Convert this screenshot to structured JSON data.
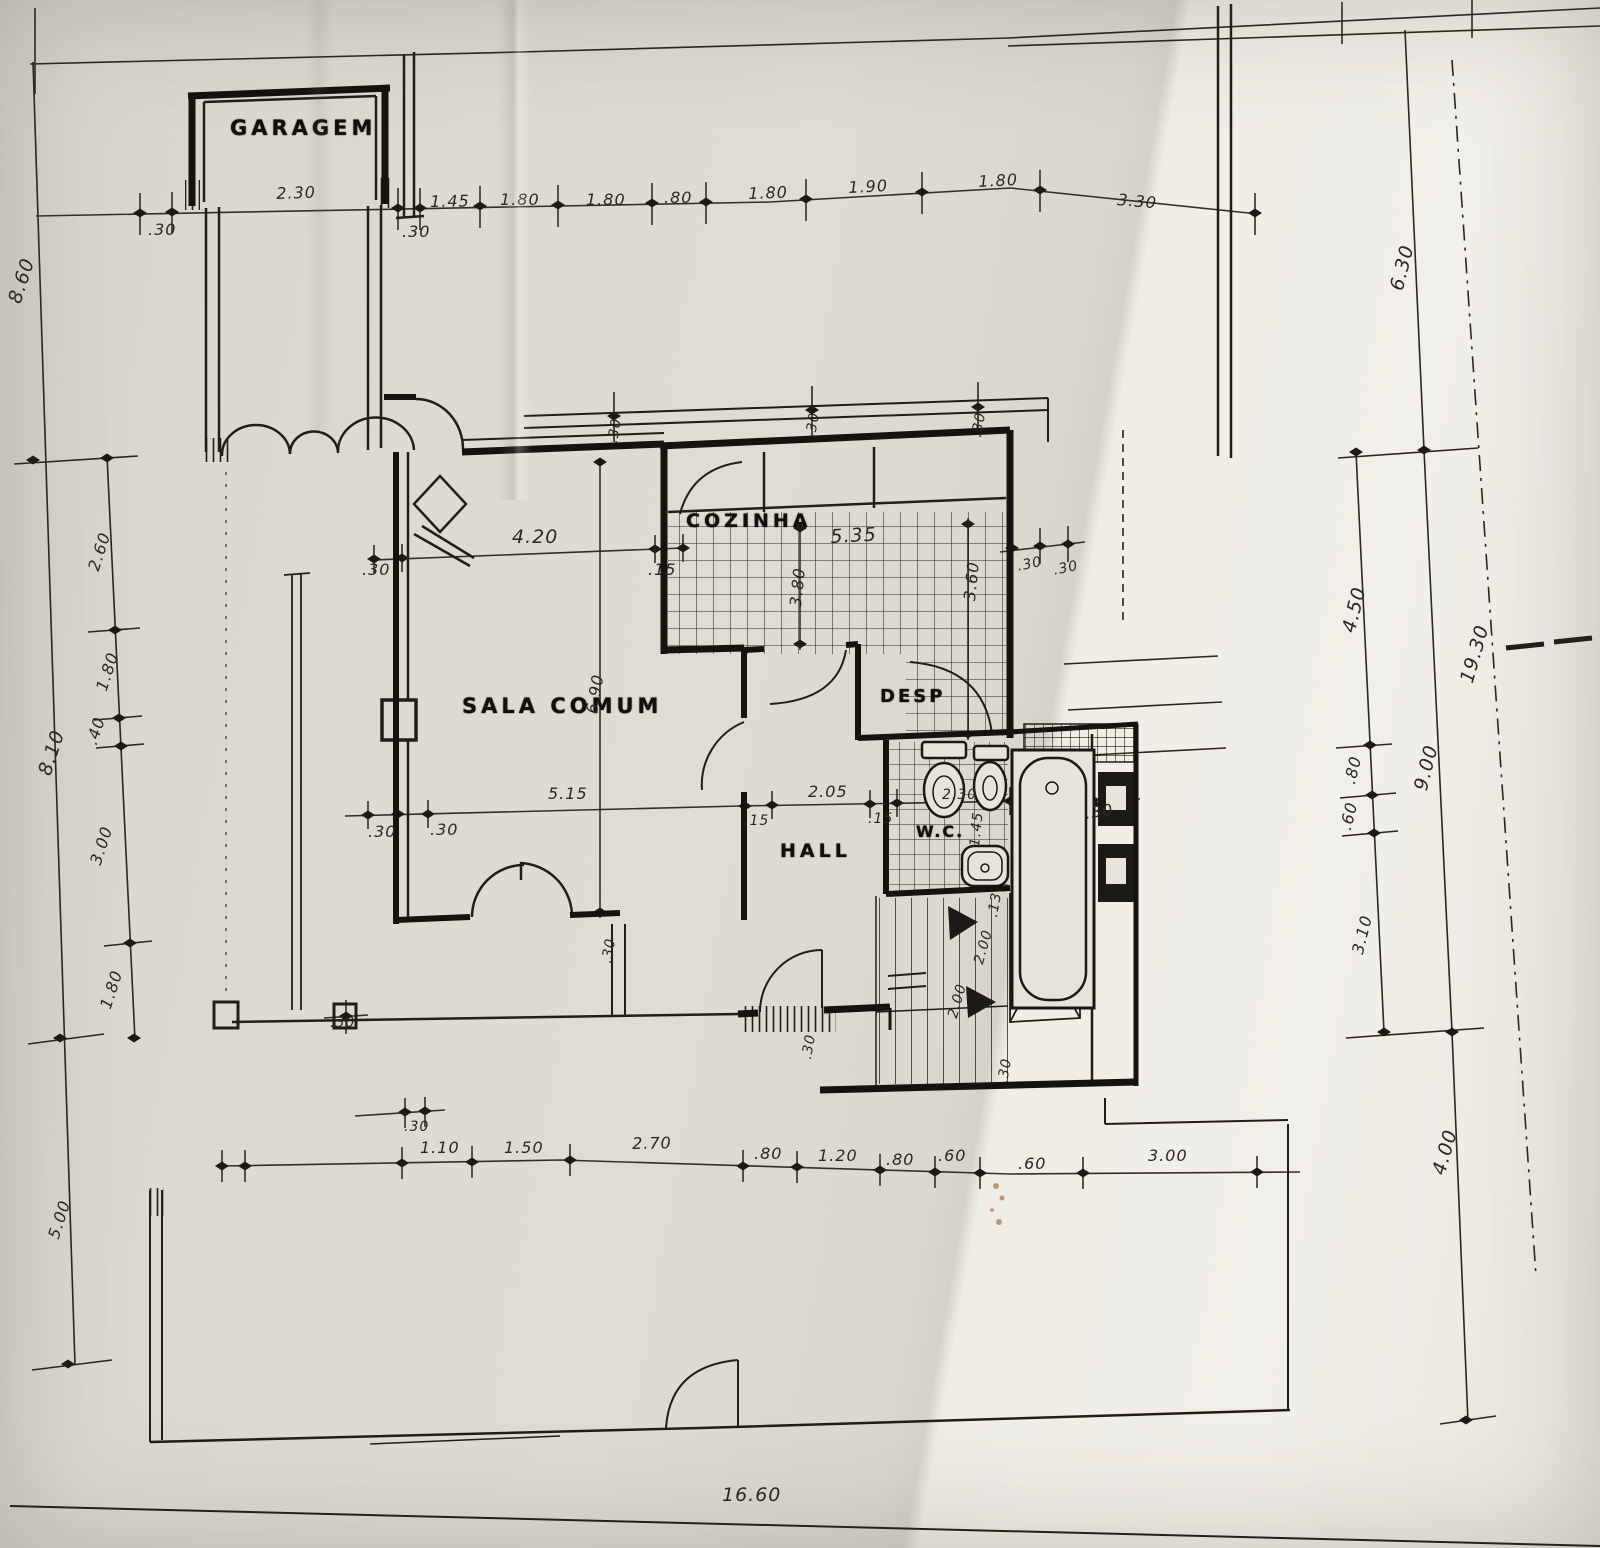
{
  "rooms": {
    "garage": "GARAGEM",
    "living": "SALA COMUM",
    "kitchen": "COZINHA",
    "pantry": "DESP",
    "hall": "HALL",
    "wc": "W.C."
  },
  "dimensions": {
    "top": [
      ".30",
      "2.30",
      ".30",
      "1.45",
      "1.80",
      "1.80",
      ".80",
      "1.80",
      "1.90",
      "1.80",
      "3.30"
    ],
    "left": [
      "8.60",
      "2.60",
      "1.80",
      "8.10",
      ".40",
      "3.00",
      "1.80",
      "5.00"
    ],
    "right": [
      "6.30",
      "4.50",
      "19.30",
      ".80",
      ".60",
      "9.00",
      "3.10",
      "4.00"
    ],
    "bottom": [
      ".30",
      "1.10",
      "1.50",
      "2.70",
      ".80",
      "1.20",
      ".80",
      ".60",
      ".60",
      "3.00"
    ],
    "overall_width": "16.60",
    "interior": [
      "4.20",
      ".30",
      ".15",
      "5.35",
      "3.80",
      "3.60",
      "6.90",
      ".30",
      ".30",
      ".30",
      ".30",
      ".30",
      ".30",
      ".30",
      "5.15",
      ".15",
      "2.05",
      ".15",
      "2.30",
      "1.45",
      ".30",
      ".13",
      "2.00",
      "2.00",
      ".30",
      ".30",
      ".30",
      ".30"
    ]
  }
}
